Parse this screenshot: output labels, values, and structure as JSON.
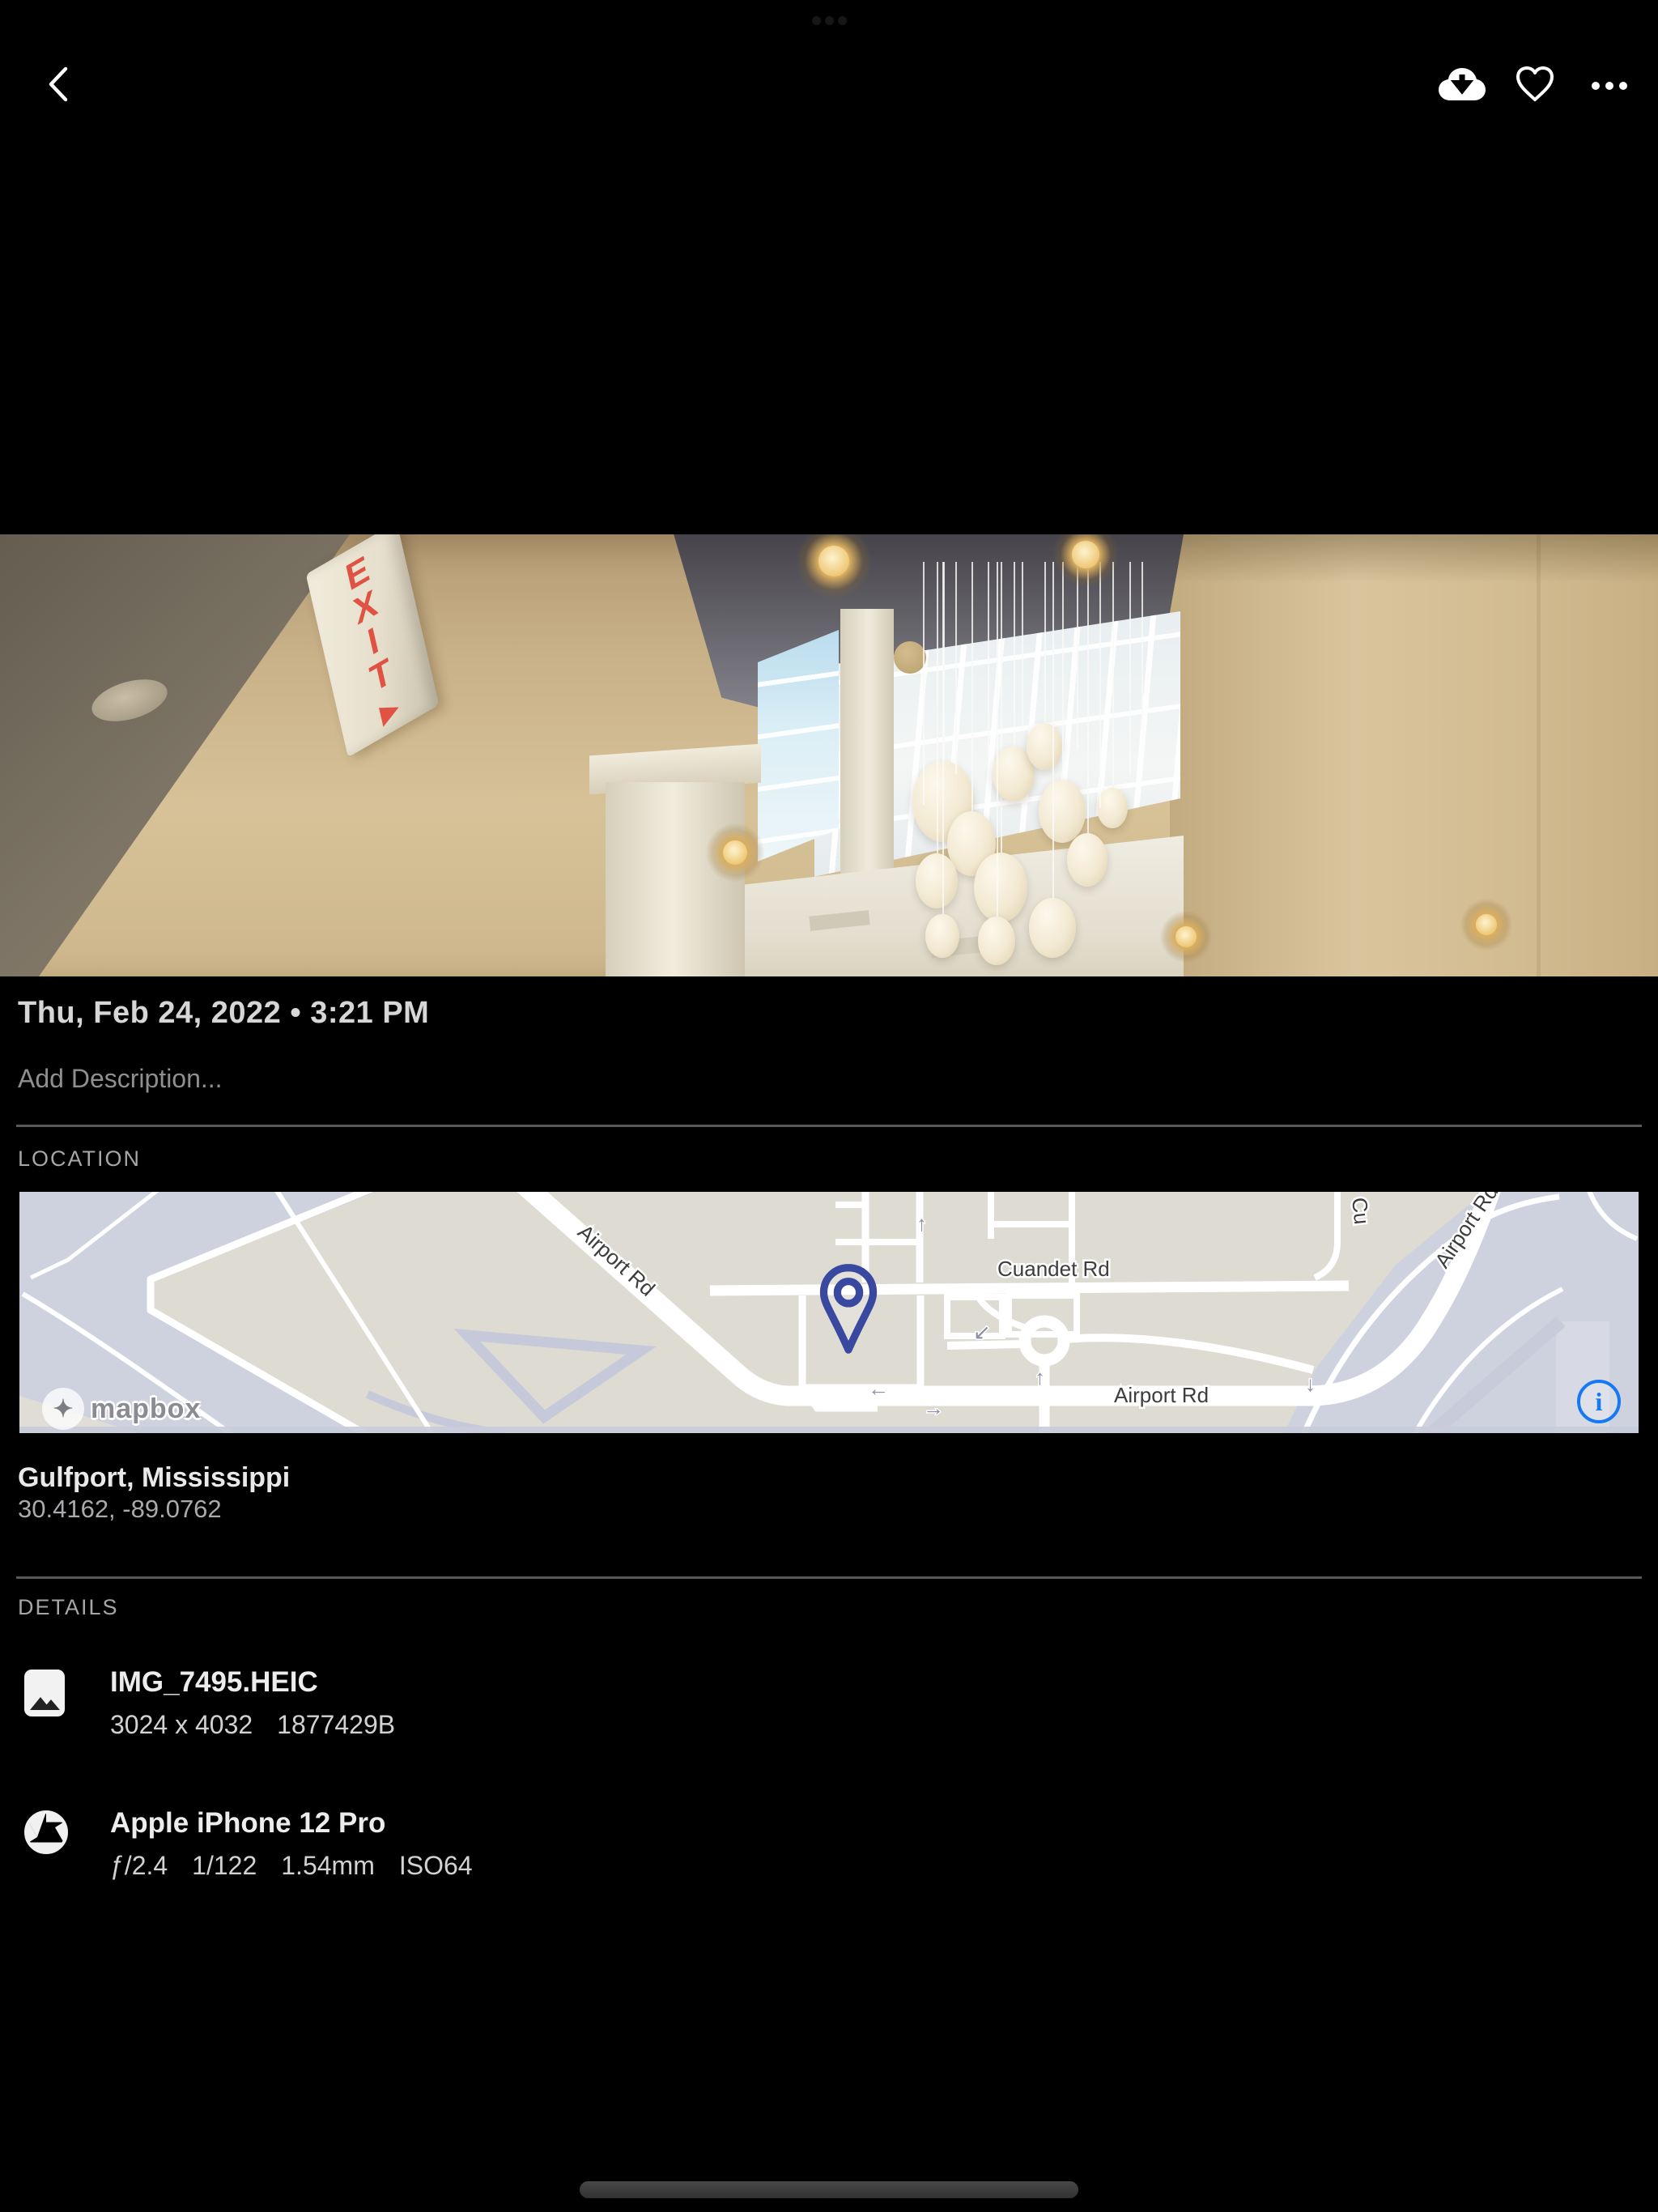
{
  "topbar": {
    "icons": {
      "back": "chevron-left",
      "download": "cloud-download",
      "favorite": "heart-outline",
      "more": "ellipsis"
    }
  },
  "photo": {
    "exit_sign": "EXIT▸"
  },
  "meta": {
    "date": "Thu, Feb 24, 2022 • 3:21 PM",
    "description_placeholder": "Add Description..."
  },
  "location": {
    "label": "LOCATION",
    "place": "Gulfport, Mississippi",
    "coordinates": "30.4162, -89.0762",
    "map": {
      "attribution": "mapbox",
      "attribution_glyph": "✦",
      "info_icon": "i",
      "labels": {
        "airport_rd_diag": "Airport Rd",
        "cuandet_rd": "Cuandet Rd",
        "airport_rd_bottom": "Airport Rd",
        "airport_rd_curve": "Airport Rd",
        "partial_road": "Cu"
      },
      "arrows": {
        "left": "←",
        "right": "→",
        "up": "↑",
        "up_small": "↑",
        "down": "↓",
        "down_left": "↙"
      }
    }
  },
  "details": {
    "label": "DETAILS",
    "file": {
      "title": "IMG_7495.HEIC",
      "dimensions": "3024 x 4032",
      "size": "1877429B"
    },
    "camera": {
      "title": "Apple iPhone 12 Pro",
      "aperture": "ƒ/2.4",
      "shutter": "1/122",
      "focal_length": "1.54mm",
      "iso": "ISO64"
    }
  },
  "colors": {
    "accent_blue": "#1678f2",
    "pin_indigo": "#3a49a0",
    "map_beige": "#dedbd3",
    "map_lavender": "#ced2df"
  }
}
